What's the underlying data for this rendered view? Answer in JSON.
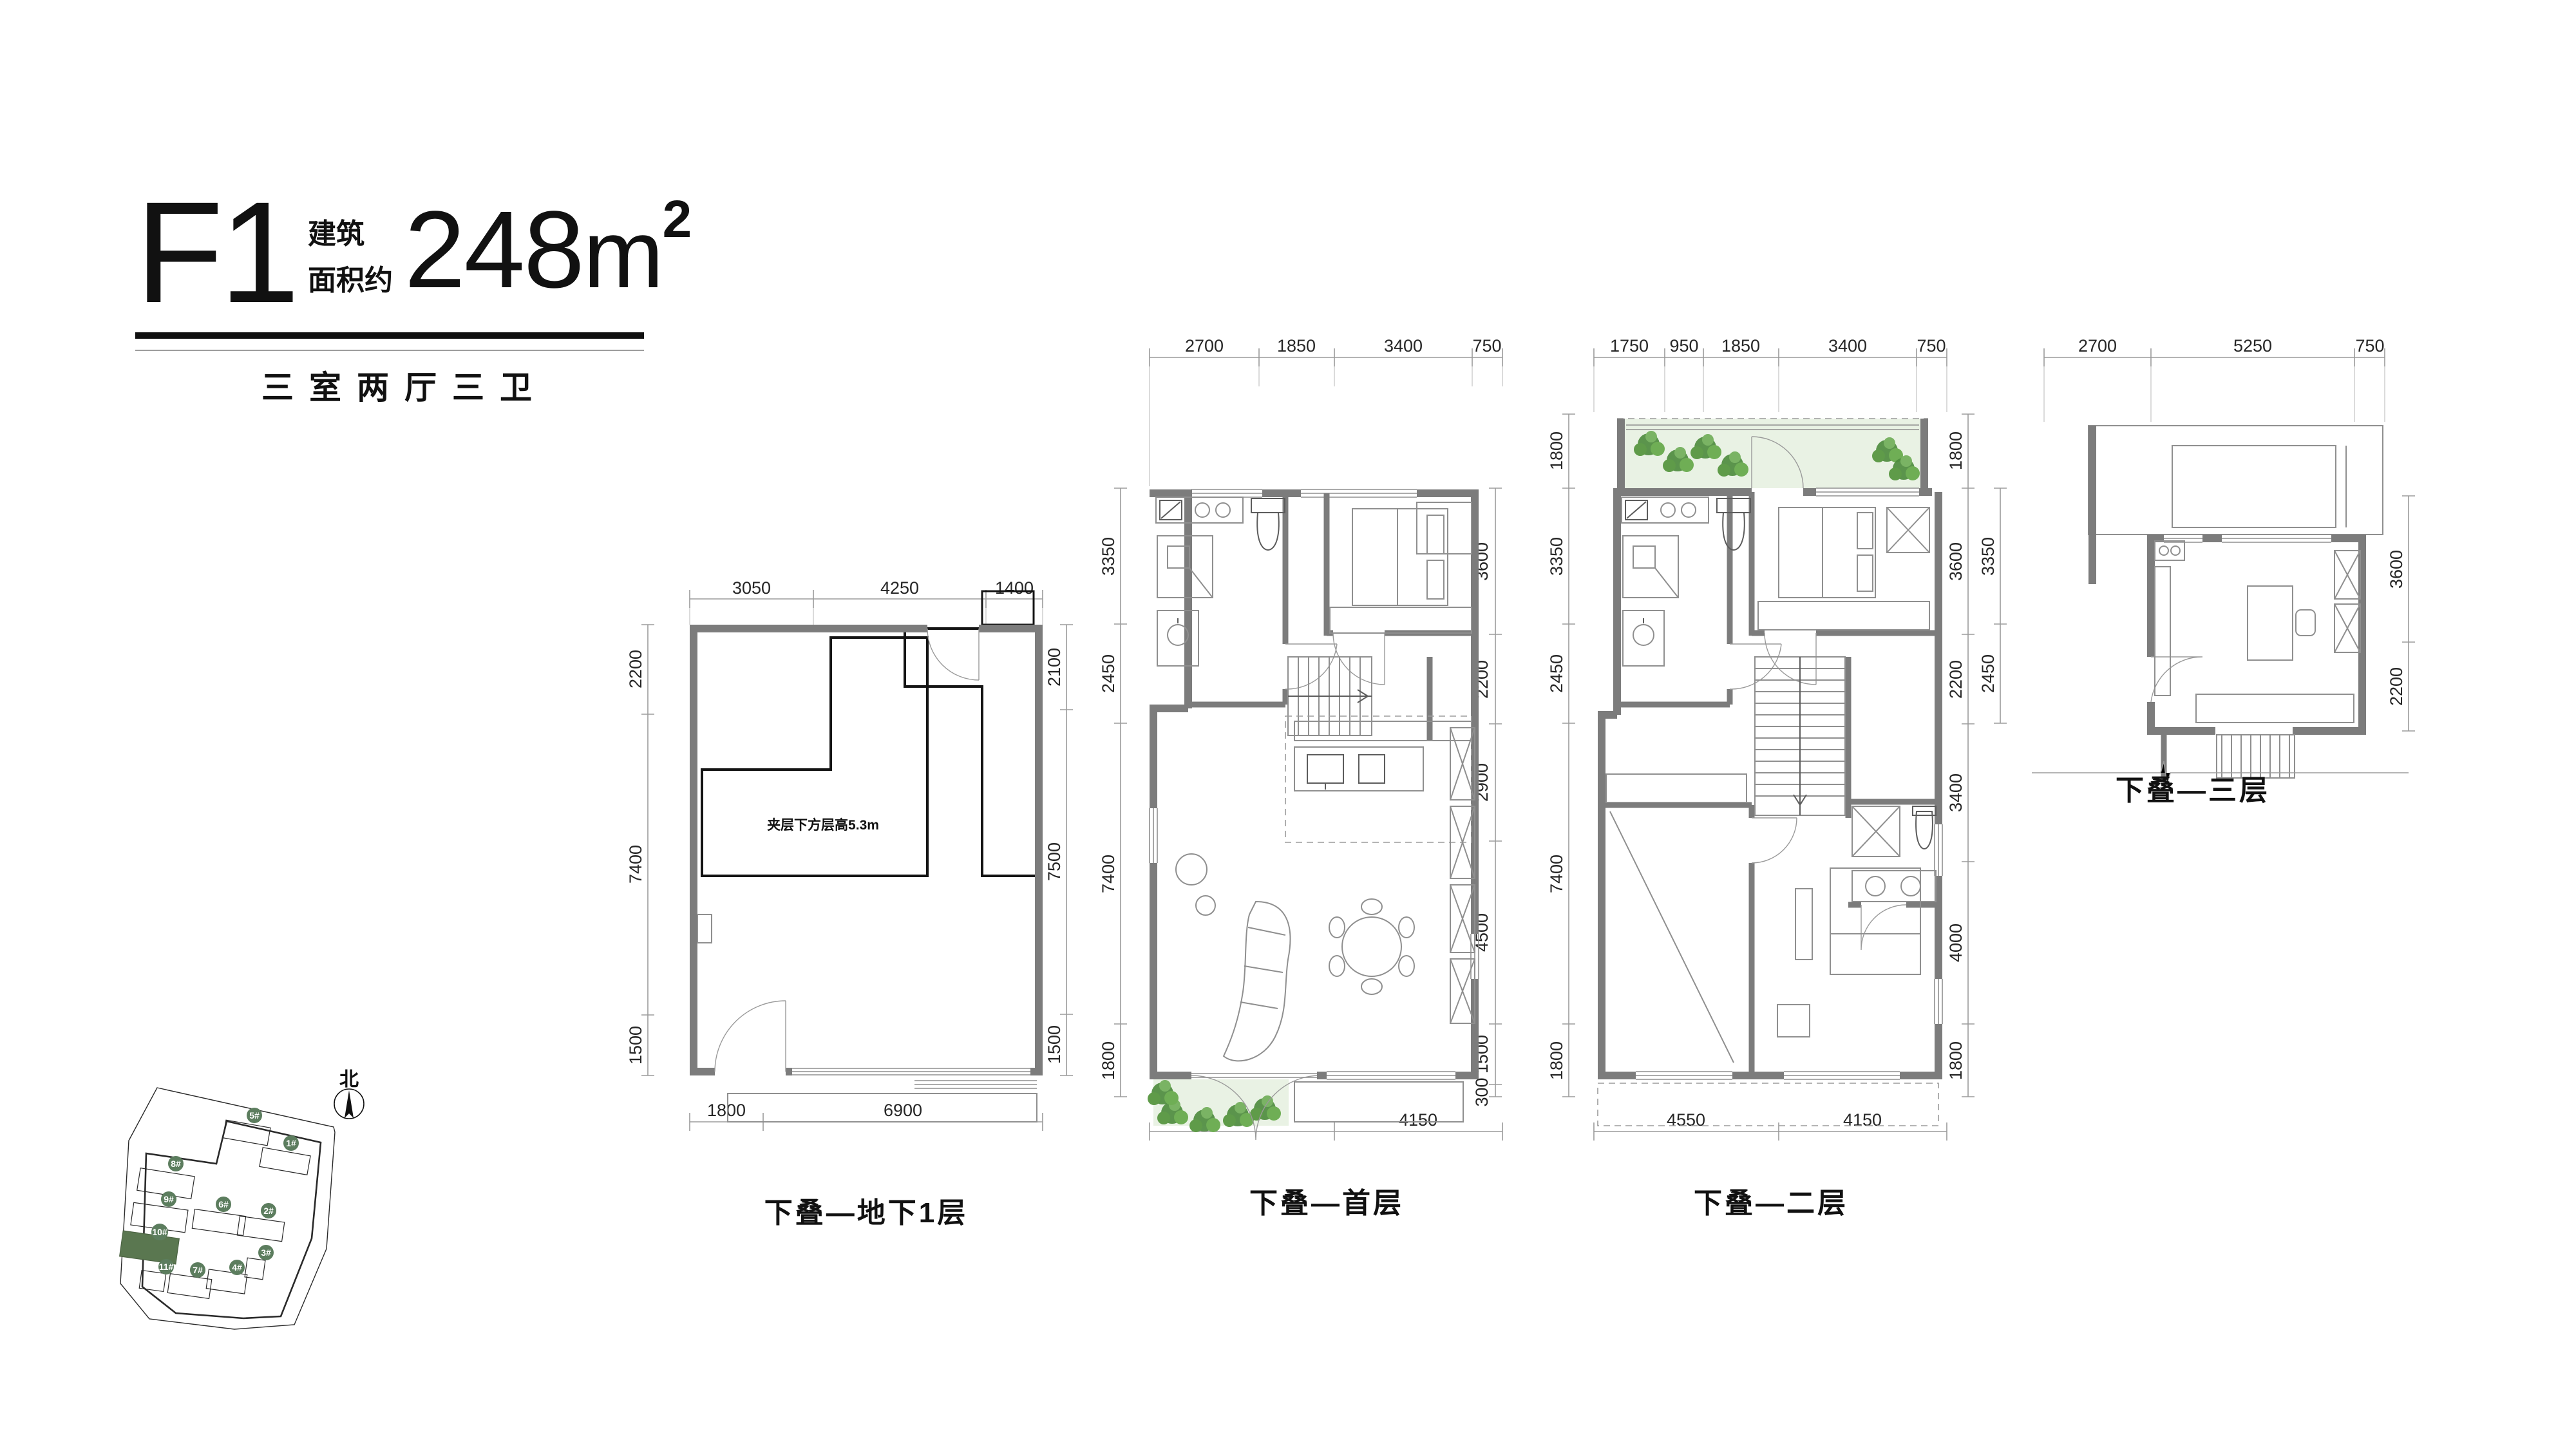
{
  "header": {
    "code": "F1",
    "area_label_line1": "建筑",
    "area_label_line2": "面积约",
    "area_value": "248",
    "area_unit": "m",
    "area_exponent": "2",
    "subtitle": "三室两厅三卫"
  },
  "plans": [
    {
      "name": "basement",
      "label": "下叠—地下1层",
      "note": "夹层下方层高5.3m",
      "dims_top": [
        "3050",
        "4250",
        "1400"
      ],
      "dims_bottom": [
        "1800",
        "6900"
      ],
      "dims_left": [
        "2200",
        "7400",
        "1500"
      ],
      "dims_right": [
        "2100",
        "7500",
        "1500"
      ]
    },
    {
      "name": "first-floor",
      "label": "下叠—首层",
      "dims_top": [
        "2700",
        "1850",
        "3400",
        "750"
      ],
      "dims_bottom": [
        "4550",
        "4150"
      ],
      "dims_left": [
        "3350",
        "2450",
        "7400",
        "1800"
      ],
      "dims_right": [
        "3600",
        "2200",
        "2900",
        "4500",
        "1500",
        "300"
      ]
    },
    {
      "name": "second-floor",
      "label": "下叠—二层",
      "dims_top": [
        "1750",
        "950",
        "1850",
        "3400",
        "750"
      ],
      "dims_bottom": [
        "4550",
        "4150"
      ],
      "dims_left": [
        "1800",
        "3350",
        "2450",
        "7400",
        "1800"
      ],
      "dims_right": [
        "1800",
        "3600",
        "2200",
        "3400",
        "4000",
        "1800"
      ]
    },
    {
      "name": "third-floor",
      "label": "下叠—三层",
      "dims_top": [
        "2700",
        "5250",
        "750"
      ],
      "dims_bottom": [],
      "dims_left": [
        "3350",
        "2450"
      ],
      "dims_right": [
        "3600",
        "2200"
      ]
    }
  ],
  "site": {
    "north_label": "北",
    "buildings": [
      "5#",
      "1#",
      "8#",
      "9#",
      "6#",
      "2#",
      "10#",
      "3#",
      "11#",
      "7#",
      "4#"
    ],
    "highlighted_building": "10#"
  },
  "colors": {
    "wall_gray": "#7c7c7c",
    "dim_line": "#9b9b9b",
    "text": "#111111",
    "badge_green": "#5c7d5e",
    "building_highlight": "#5a7750",
    "garden_green": "#e9f2e4",
    "plant_green": "#5f9549"
  }
}
